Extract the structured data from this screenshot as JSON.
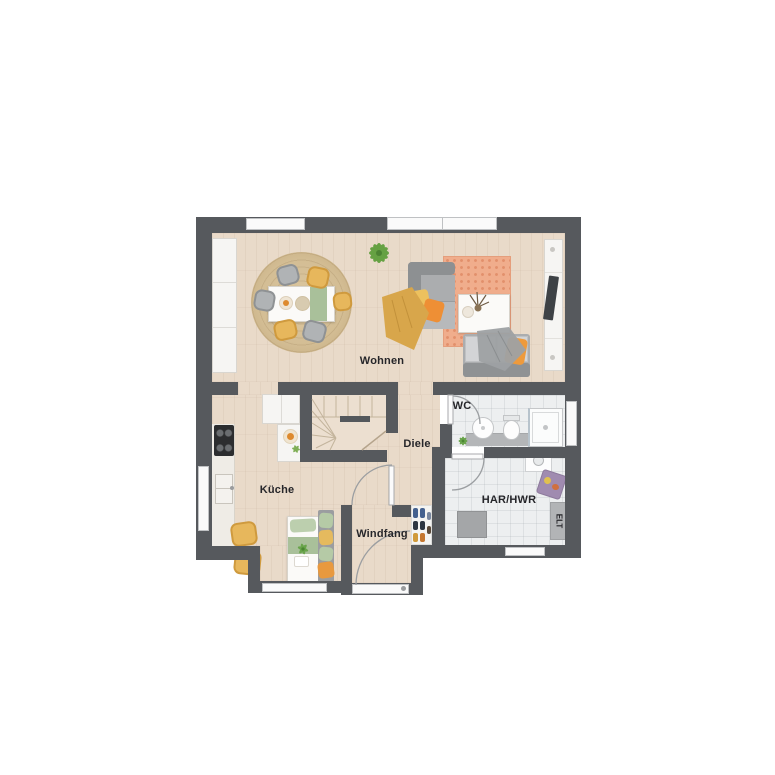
{
  "plan": {
    "type": "floor-plan",
    "labels": {
      "wohnen": "Wohnen",
      "kueche": "Küche",
      "diele": "Diele",
      "wc": "WC",
      "har_hwr": "HAR/HWR",
      "windfang": "Windfang",
      "elt": "ELT"
    },
    "furniture": {
      "wohnen": [
        "tall-cabinet",
        "round-jute-rug",
        "dining-table",
        "dining-chairs",
        "plant",
        "corner-sofa",
        "throw-blanket",
        "area-rug",
        "coffee-table",
        "sofa",
        "tv-sideboard",
        "tv"
      ],
      "kueche": [
        "kitchen-counter",
        "cooktop",
        "sink",
        "storage-cabinet",
        "fruit-bowl",
        "breakfast-table",
        "chairs",
        "bench"
      ],
      "wc": [
        "washbasin",
        "toilet",
        "shower",
        "vanity",
        "plant"
      ],
      "har_hwr": [
        "washing-machine",
        "laundry-basket",
        "freezer",
        "electrical-panel"
      ],
      "windfang": [
        "entrance-door",
        "shoe-shelf"
      ]
    }
  },
  "colors": {
    "wall": "#56595d",
    "wood_floor": "#e9dac9",
    "tile_floor": "#edeff0",
    "window_white": "#fafafa",
    "rug_jute": "#d3bd94",
    "rug_orange": "#f0ad8c",
    "sofa_grey": "#abadaf",
    "accent_yellow": "#e7b75c",
    "accent_orange": "#ee8f35",
    "accent_green": "#a9c09a",
    "label_text": "#26262a"
  }
}
